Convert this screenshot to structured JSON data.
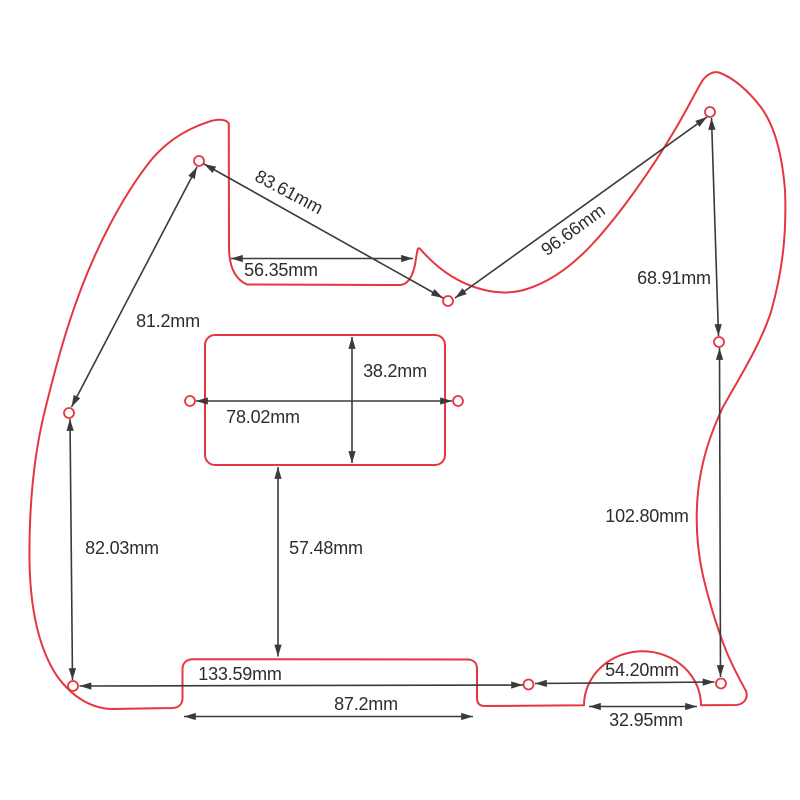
{
  "page": {
    "background": "#ffffff",
    "description": "Telecaster pickguard dimension drawing"
  },
  "drawing": {
    "outline_color": "#e63740",
    "dimension_line_color": "#3a3a3a",
    "text_color": "#2d2d2d",
    "unit": "mm",
    "dimensions": [
      {
        "id": "neck-hole-to-middle-hole",
        "label": "83.61mm",
        "value": 83.61
      },
      {
        "id": "horn-edge-to-notch",
        "label": "56.35mm",
        "value": 56.35
      },
      {
        "id": "middle-hole-to-top-right-hole",
        "label": "96.66mm",
        "value": 96.66
      },
      {
        "id": "top-right-hole-to-right-side-hole",
        "label": "68.91mm",
        "value": 68.91
      },
      {
        "id": "neck-hole-to-left-edge-hole",
        "label": "81.2mm",
        "value": 81.2
      },
      {
        "id": "pickup-cutout-height",
        "label": "38.2mm",
        "value": 38.2
      },
      {
        "id": "pickup-cutout-width",
        "label": "78.02mm",
        "value": 78.02
      },
      {
        "id": "right-side-hole-to-bottom-right-hole",
        "label": "102.80mm",
        "value": 102.8
      },
      {
        "id": "left-edge-hole-to-bottom-left-hole",
        "label": "82.03mm",
        "value": 82.03
      },
      {
        "id": "pickup-cutout-to-bottom-recess-edge",
        "label": "57.48mm",
        "value": 57.48
      },
      {
        "id": "bottom-left-hole-to-bottom-middle-hole",
        "label": "133.59mm",
        "value": 133.59
      },
      {
        "id": "bottom-middle-hole-to-bottom-right-hole",
        "label": "54.20mm",
        "value": 54.2
      },
      {
        "id": "bottom-recess-width",
        "label": "87.2mm",
        "value": 87.2
      },
      {
        "id": "semicircle-cutout-width",
        "label": "32.95mm",
        "value": 32.95
      }
    ]
  }
}
